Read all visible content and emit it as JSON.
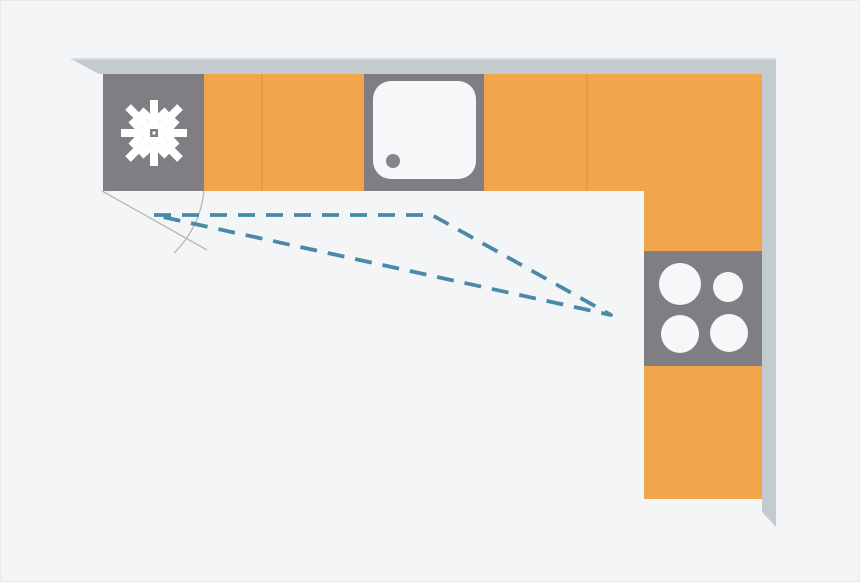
{
  "diagram": {
    "type": "kitchen-floor-plan",
    "shape": "l-shaped",
    "appliances": [
      {
        "id": "fridge",
        "icon": "snowflake-icon",
        "location": "top-run-left"
      },
      {
        "id": "sink",
        "icon": "sink-basin",
        "location": "top-run-center"
      },
      {
        "id": "hob",
        "icon": "four-burners",
        "burners": 4,
        "location": "right-column-middle"
      }
    ],
    "cabinets": {
      "top_run_orange_sections": 4,
      "right_column_orange_sections": 2,
      "seam_positions_x": [
        260,
        585
      ]
    },
    "work_triangle": {
      "style": "dashed",
      "vertices": [
        {
          "name": "fridge-vertex",
          "x": 153,
          "y": 214
        },
        {
          "name": "sink-vertex",
          "x": 431,
          "y": 214
        },
        {
          "name": "hob-vertex",
          "x": 610,
          "y": 314
        }
      ]
    },
    "door_swing": {
      "hinge": {
        "x": 101,
        "y": 190
      },
      "line_end": {
        "x": 206,
        "y": 249
      },
      "arc_start": {
        "x": 203,
        "y": 190
      },
      "arc_end": {
        "x": 173,
        "y": 252
      }
    },
    "colors": {
      "background": "#f4f5f6",
      "cabinet": "#f2a64c",
      "cabinet_seam": "#df9a44",
      "appliance": "#7f7f83",
      "wall": "#c3cbcf",
      "fixture_white": "#f6f7f9",
      "triangle_dash": "#4a89a8",
      "door_swing_line": "#b6b9bb",
      "snowflake": "#ffffff"
    }
  }
}
